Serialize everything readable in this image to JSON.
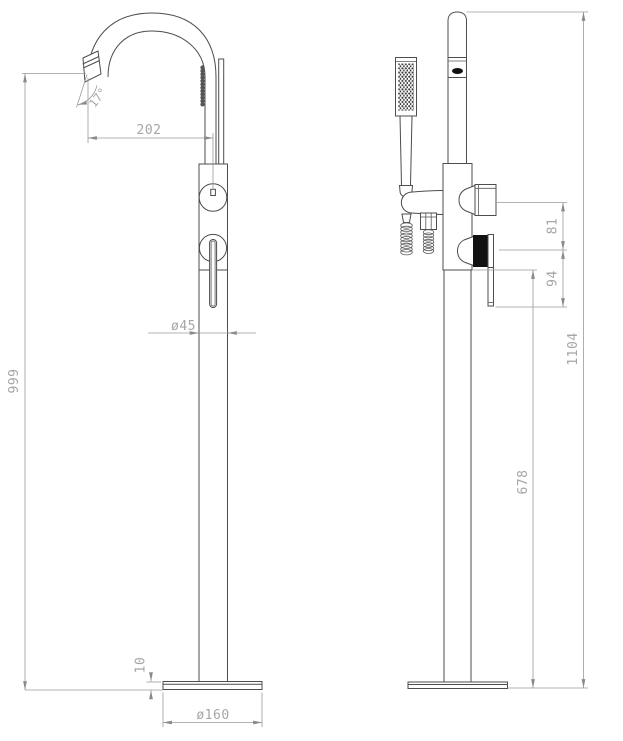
{
  "dims": {
    "spout_angle": "17°",
    "spout_reach": "202",
    "column_diameter": "ø45",
    "spout_height": "999",
    "base_thickness": "10",
    "base_diameter": "ø160",
    "diverter_spacing": "81",
    "handle_spacing": "94",
    "lever_height": "678",
    "total_height": "1104"
  },
  "colors": {
    "part_line": "#4d4d4d",
    "dimension_line": "#9a9a9a",
    "dimension_text": "#a6a6a6",
    "dark_fill": "#111111",
    "background": "#ffffff"
  }
}
